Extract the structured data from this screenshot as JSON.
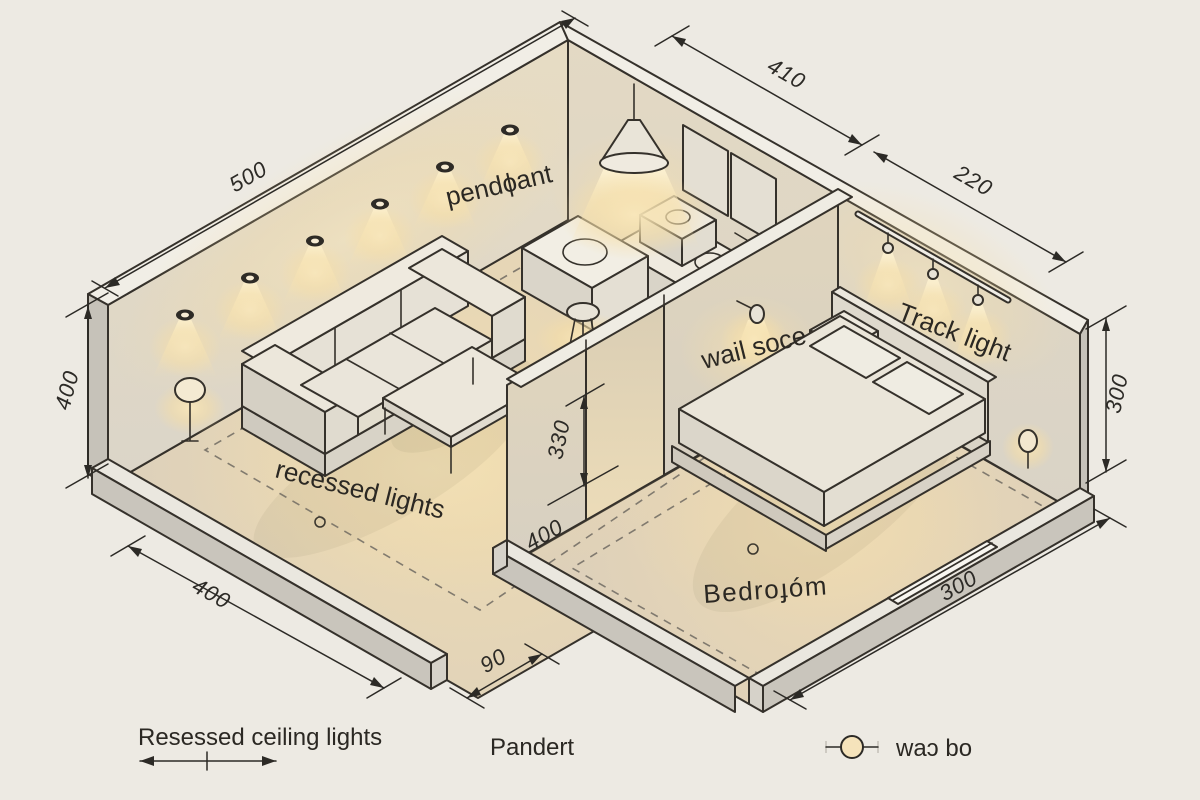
{
  "colors": {
    "background": "#edeae3",
    "line": "#35312b",
    "dimension": "#2c2a26",
    "text": "#2b2823",
    "wall": "#dcd6ca",
    "wall_rim": "#f1eee6",
    "wall_side": "#c6c2b9",
    "floor_warm": "#ecdab4",
    "floor_edge": "#dccfba",
    "glow": "#f7e0ab",
    "furniture": "#e7e2d6"
  },
  "scene_labels": {
    "pendant": "pendɸant",
    "wall_sconce": "wail soce",
    "track_light": "Track light",
    "recessed": "recessed lights",
    "bedroom": "Bedroɟóm"
  },
  "dimensions": {
    "wall_back_left": "500",
    "wall_kitchen": "410",
    "wall_bedroom_back": "220",
    "height_left": "400",
    "height_right": "300",
    "partition_height": "330",
    "partition_offset": "400",
    "door_gap": "90",
    "wall_front_left": "400",
    "wall_front_right": "300"
  },
  "legend": {
    "recessed_label": "Resessed ceiling lights",
    "pendant_label": "Pandert",
    "sconce_label": "waɔ bo"
  }
}
